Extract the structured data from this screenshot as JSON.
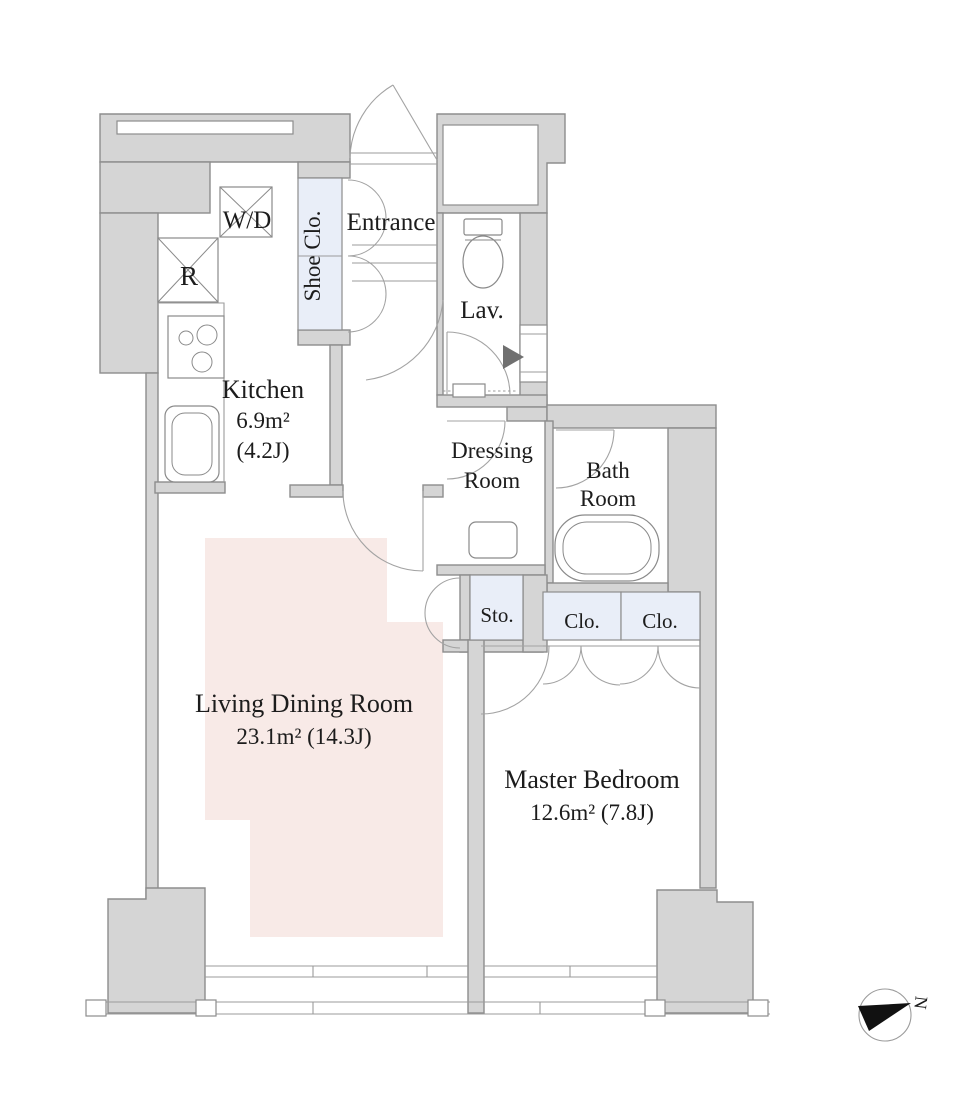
{
  "colors": {
    "wall_fill": "#d5d5d5",
    "wall_stroke": "#8d8d8d",
    "closet_fill": "#e9eef8",
    "living_fill": "#f8eae7",
    "line": "#9b9b9b",
    "text": "#1c1c1c",
    "compass_fill": "#111111"
  },
  "rooms": {
    "entrance": {
      "label": "Entrance"
    },
    "shoe_closet": {
      "label": "Shoe Clo."
    },
    "washer_dryer": {
      "label": "W/D"
    },
    "refrigerator": {
      "label": "R"
    },
    "kitchen": {
      "label": "Kitchen",
      "area_m2": "6.9m²",
      "area_jo": "(4.2J)"
    },
    "lavatory": {
      "label": "Lav."
    },
    "dressing_room": {
      "line1": "Dressing",
      "line2": "Room"
    },
    "bath_room": {
      "line1": "Bath",
      "line2": "Room"
    },
    "storage": {
      "label": "Sto."
    },
    "closet_left": {
      "label": "Clo."
    },
    "closet_right": {
      "label": "Clo."
    },
    "living_dining": {
      "label": "Living Dining Room",
      "area": "23.1m²  (14.3J)"
    },
    "master_bedroom": {
      "label": "Master Bedroom",
      "area": "12.6m²  (7.8J)"
    }
  },
  "compass": {
    "north_label": "N"
  }
}
